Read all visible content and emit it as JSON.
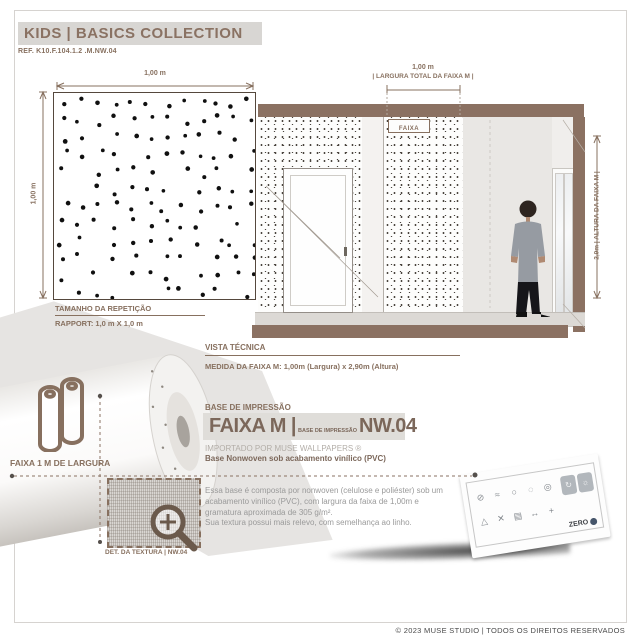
{
  "header": {
    "title": "KIDS | BASICS COLLECTION",
    "ref": "REF. K10.F.104.1.2 .M.NW.04"
  },
  "swatch": {
    "width_label": "1,00 m",
    "height_label": "1,00 m",
    "repeat_title": "TAMANHO DA REPETIÇÃO",
    "repeat_value": "RAPPORT: 1,0 m X 1,0 m"
  },
  "room": {
    "strip_width_value": "1,00 m",
    "strip_width_caption": "| LARGURA TOTAL DA FAIXA M |",
    "strip_tag": "FAIXA",
    "height_caption": "2,9m |  ALTURA DA FAIXA M |"
  },
  "technical": {
    "title": "VISTA TÉCNICA",
    "measure": "MEDIDA DA FAIXA M: 1,00m (Largura) x 2,90m (Altura)"
  },
  "roll_info": {
    "width_label": "FAIXA 1 M DE LARGURA"
  },
  "texture_detail": {
    "label": "DET. DA TEXTURA | NW.04"
  },
  "base": {
    "section_title": "BASE DE IMPRESSÃO",
    "name": "FAIXA M |",
    "name_sub": "BASE DE IMPRESSÃO",
    "code": "NW.04",
    "importer": "IMPORTADO POR MUSE WALLPAPERS ®",
    "base_line": "Base Nonwoven sob acabamento vinílico (PVC)",
    "description_1": "Essa base é composta por nonwoven (celulose e poliéster) sob um acabamento vinílico (PVC), com largura da faixa de 1,00m e gramatura aproximada de 305 g/m².",
    "description_2": "Sua textura possui mais relevo, com semelhança ao linho."
  },
  "care_card": {
    "zero_label": "ZERO",
    "icons": [
      "no-bleach-icon",
      "washable-icon",
      "color-fast-icon",
      "strippable-icon",
      "wheel-icon",
      "fire-icon",
      "mold-icon",
      "paste-icon",
      "pattern-icon",
      "tools-icon"
    ]
  },
  "footer": {
    "copyright": "© 2023 MUSE STUDIO | TODOS OS DIREITOS RESERVADOS"
  },
  "colors": {
    "accent": "#87705f",
    "band": "#8b7162",
    "header_bg": "#d8d6d3",
    "wall_light": "#e9e7e4",
    "text_gray": "#9a9a9a"
  }
}
